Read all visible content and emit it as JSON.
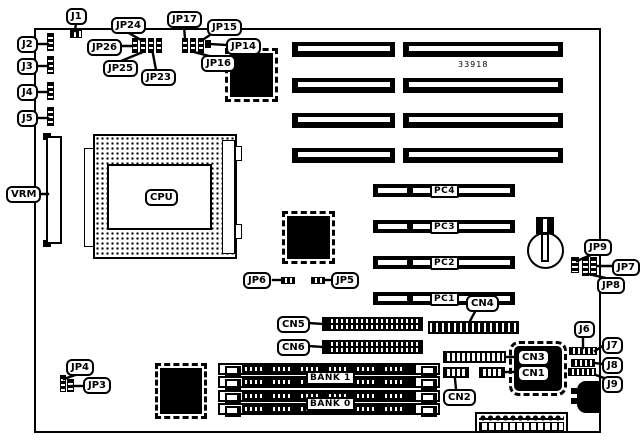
{
  "board": {
    "part_number": "33918"
  },
  "labels": {
    "j1": "J1",
    "j2": "J2",
    "j3": "J3",
    "j4": "J4",
    "j5": "J5",
    "j6": "J6",
    "j7": "J7",
    "j8": "J8",
    "j9": "J9",
    "jp3": "JP3",
    "jp4": "JP4",
    "jp5": "JP5",
    "jp6": "JP6",
    "jp7": "JP7",
    "jp8": "JP8",
    "jp9": "JP9",
    "jp14": "JP14",
    "jp15": "JP15",
    "jp16": "JP16",
    "jp17": "JP17",
    "jp23": "JP23",
    "jp24": "JP24",
    "jp25": "JP25",
    "jp26": "JP26",
    "vrm": "VRM",
    "cpu": "CPU",
    "pc1": "PC1",
    "pc2": "PC2",
    "pc3": "PC3",
    "pc4": "PC4",
    "cn1": "CN1",
    "cn2": "CN2",
    "cn3": "CN3",
    "cn4": "CN4",
    "cn5": "CN5",
    "cn6": "CN6",
    "bank0": "BANK 0",
    "bank1": "BANK 1"
  }
}
